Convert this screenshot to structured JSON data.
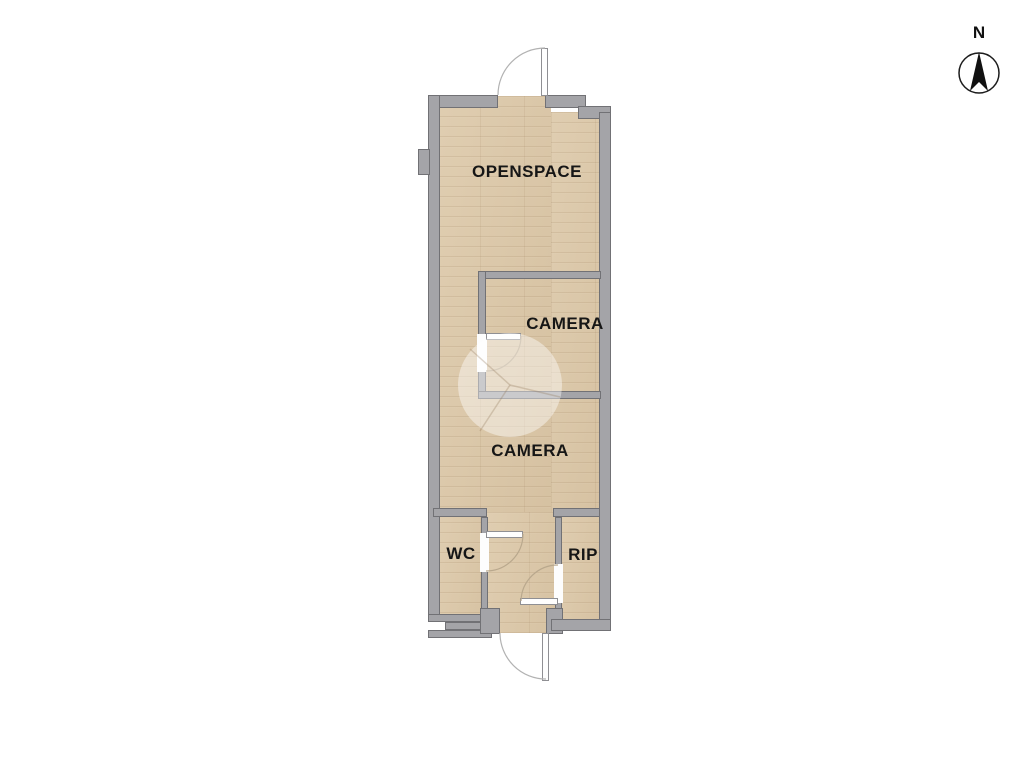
{
  "plan": {
    "type": "floor-plan",
    "rooms": [
      {
        "id": "openspace",
        "label": "OPENSPACE"
      },
      {
        "id": "camera-1",
        "label": "CAMERA"
      },
      {
        "id": "camera-2",
        "label": "CAMERA"
      },
      {
        "id": "wc",
        "label": "WC"
      },
      {
        "id": "rip",
        "label": "RIP"
      }
    ],
    "door_count": 5
  },
  "compass": {
    "north_label": "N"
  },
  "colors": {
    "floor": "#dcc8a8",
    "wall_fill": "#a4a4a8",
    "wall_edge": "#717175",
    "label_text": "#161616",
    "background": "#ffffff"
  }
}
